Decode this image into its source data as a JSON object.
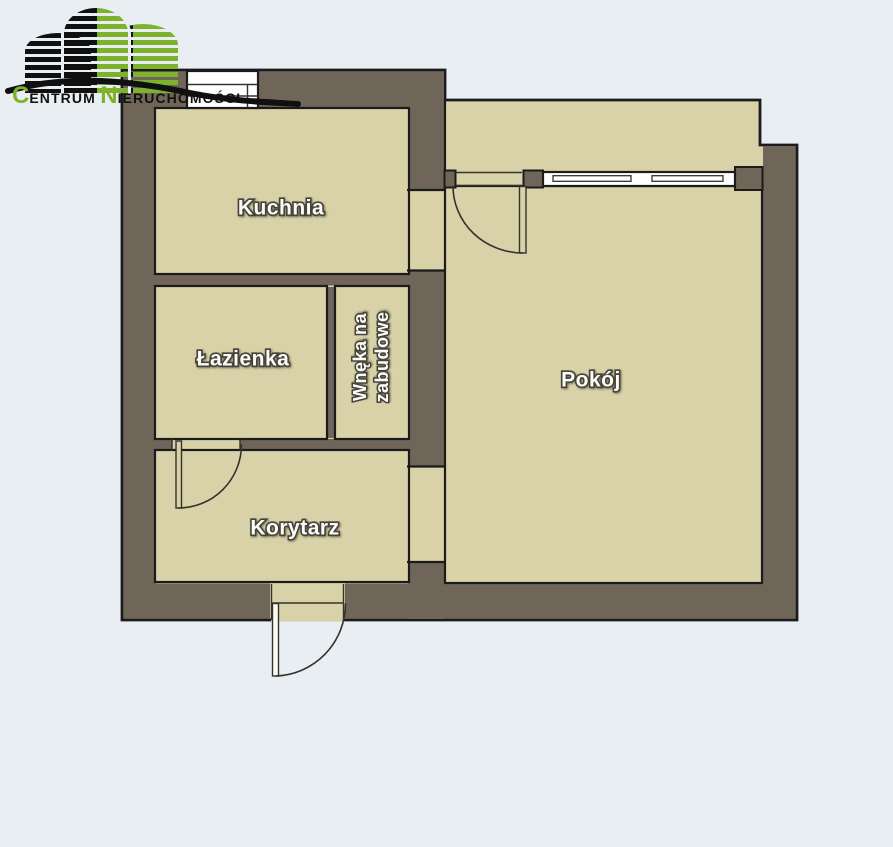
{
  "logo": {
    "initial1": "C",
    "word1": "ENTRUM",
    "initial2": "N",
    "word2": "IERUCHOMOŚCI"
  },
  "floor_plan": {
    "rooms": {
      "kuchnia": "Kuchnia",
      "lazienka": "Łazienka",
      "wneka_line1": "Wnęka na",
      "wneka_line2": "zabudowe",
      "korytarz": "Korytarz",
      "pokoj": "Pokój"
    }
  },
  "colors": {
    "bg": "#e9eef2",
    "wall": "#6f6559",
    "room": "#d9d2a8",
    "outline": "#1b1b1b",
    "thin": "#33322c",
    "logo_green": "#7db32c",
    "logo_dark": "#101010",
    "label_fill": "#fcfcf6",
    "label_stroke": "#45433a"
  }
}
